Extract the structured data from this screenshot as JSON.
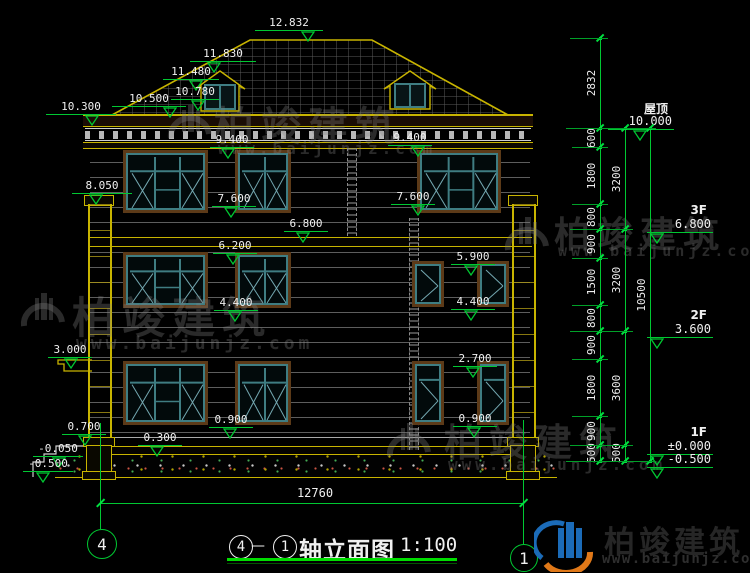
{
  "title_block": {
    "axis_start": "4",
    "separator": "—",
    "axis_end": "1",
    "name": "轴立面图",
    "scale": "1:100"
  },
  "brand": {
    "name": "柏竣建筑",
    "url": "www.baijunjz.com"
  },
  "bottom_dimension": {
    "overall_width": "12760"
  },
  "axis_bubbles": [
    {
      "number": "4",
      "cx": 101,
      "cy": 543,
      "r": 14
    },
    {
      "number": "1",
      "cx": 523,
      "cy": 557,
      "r": 13
    }
  ],
  "colors": {
    "dim_green": "#00c832",
    "bright_green": "#00e040",
    "text_white": "#f0f0f0",
    "outline_yellow": "#c8b400",
    "window_teal": "#3f7d82",
    "glazing_teal": "#74a8b1",
    "frame_brown": "#5c3a18",
    "watermark_gray": "rgba(130,130,130,0.32)",
    "logo_blue": "#1b6bb8",
    "logo_orange": "#e07818",
    "title_underline": "#00dd00"
  },
  "elevation_markers": [
    {
      "v": "12.832",
      "x": 255,
      "y": 31,
      "w": 68,
      "tx": 308
    },
    {
      "v": "11.830",
      "x": 190,
      "y": 62,
      "w": 66,
      "tx": 214
    },
    {
      "v": "11.480",
      "x": 163,
      "y": 80,
      "w": 56,
      "tx": 196
    },
    {
      "v": "10.780",
      "x": 171,
      "y": 100,
      "w": 48,
      "tx": 198
    },
    {
      "v": "10.500",
      "x": 112,
      "y": 107,
      "w": 74,
      "tx": 170
    },
    {
      "v": "10.300",
      "x": 46,
      "y": 115,
      "w": 70,
      "tx": 92
    },
    {
      "v": "9.400",
      "x": 210,
      "y": 148,
      "w": 44,
      "tx": 228
    },
    {
      "v": "9.400",
      "x": 388,
      "y": 146,
      "w": 44,
      "tx": 418
    },
    {
      "v": "8.050",
      "x": 72,
      "y": 194,
      "w": 60,
      "tx": 96
    },
    {
      "v": "7.600",
      "x": 212,
      "y": 207,
      "w": 44,
      "tx": 231
    },
    {
      "v": "7.600",
      "x": 391,
      "y": 205,
      "w": 44,
      "tx": 418
    },
    {
      "v": "6.800",
      "x": 284,
      "y": 232,
      "w": 44,
      "tx": 303
    },
    {
      "v": "6.200",
      "x": 213,
      "y": 254,
      "w": 44,
      "tx": 233
    },
    {
      "v": "5.900",
      "x": 451,
      "y": 265,
      "w": 44,
      "tx": 471
    },
    {
      "v": "4.400",
      "x": 214,
      "y": 311,
      "w": 44,
      "tx": 235
    },
    {
      "v": "4.400",
      "x": 451,
      "y": 310,
      "w": 44,
      "tx": 471
    },
    {
      "v": "3.000",
      "x": 48,
      "y": 358,
      "w": 44,
      "tx": 71
    },
    {
      "v": "2.700",
      "x": 453,
      "y": 367,
      "w": 44,
      "tx": 473
    },
    {
      "v": "0.900",
      "x": 209,
      "y": 428,
      "w": 44,
      "tx": 230
    },
    {
      "v": "0.900",
      "x": 453,
      "y": 427,
      "w": 44,
      "tx": 474
    },
    {
      "v": "0.700",
      "x": 62,
      "y": 435,
      "w": 44,
      "tx": 85
    },
    {
      "v": "0.300",
      "x": 138,
      "y": 446,
      "w": 44,
      "tx": 157
    },
    {
      "v": "-0.050",
      "x": 33,
      "y": 457,
      "w": 50,
      "tx": 59
    },
    {
      "v": "-0.500",
      "x": 23,
      "y": 472,
      "w": 50,
      "tx": 43
    }
  ],
  "floor_levels": [
    {
      "floor": "屋顶",
      "value": "10.000",
      "x": 608,
      "y": 130,
      "w": 66,
      "tx": 640
    },
    {
      "floor": "3F",
      "value": "6.800",
      "x": 647,
      "y": 233,
      "w": 66,
      "tx": 657
    },
    {
      "floor": "2F",
      "value": "3.600",
      "x": 647,
      "y": 338,
      "w": 66,
      "tx": 657
    },
    {
      "floor": "1F",
      "value": "±0.000",
      "x": 647,
      "y": 455,
      "w": 66,
      "tx": 657
    },
    {
      "floor": "",
      "value": "-0.500",
      "x": 647,
      "y": 468,
      "w": 66,
      "tx": 657
    }
  ],
  "dim_chains": [
    {
      "x": 600,
      "boundaries": [
        38,
        128,
        147,
        204,
        229,
        258,
        305,
        331,
        359,
        416,
        445,
        461
      ],
      "labels": [
        "2832",
        "600",
        "1800",
        "800",
        "900",
        "1500",
        "800",
        "900",
        "1800",
        "900",
        "500"
      ]
    },
    {
      "x": 625,
      "boundaries": [
        128,
        229,
        331,
        445,
        461
      ],
      "labels": [
        "3200",
        "3200",
        "3600",
        "500"
      ]
    },
    {
      "x": 650,
      "boundaries": [
        128,
        461
      ],
      "labels": [
        "10500"
      ]
    }
  ],
  "extension_lines": [
    {
      "y": 38,
      "x1": 570,
      "x2": 608
    },
    {
      "y": 128,
      "x1": 566,
      "x2": 656
    },
    {
      "y": 147,
      "x1": 572,
      "x2": 608
    },
    {
      "y": 204,
      "x1": 572,
      "x2": 608
    },
    {
      "y": 229,
      "x1": 570,
      "x2": 633
    },
    {
      "y": 258,
      "x1": 572,
      "x2": 608
    },
    {
      "y": 305,
      "x1": 572,
      "x2": 608
    },
    {
      "y": 331,
      "x1": 570,
      "x2": 633
    },
    {
      "y": 359,
      "x1": 572,
      "x2": 608
    },
    {
      "y": 416,
      "x1": 572,
      "x2": 608
    },
    {
      "y": 445,
      "x1": 570,
      "x2": 633
    },
    {
      "y": 461,
      "x1": 566,
      "x2": 656
    }
  ],
  "windows": [
    {
      "x": 123,
      "y": 150,
      "w": 85,
      "h": 63,
      "type": "w3"
    },
    {
      "x": 235,
      "y": 150,
      "w": 56,
      "h": 63,
      "type": "w2"
    },
    {
      "x": 417,
      "y": 150,
      "w": 84,
      "h": 63,
      "type": "w3"
    },
    {
      "x": 123,
      "y": 252,
      "w": 85,
      "h": 56,
      "type": "w3"
    },
    {
      "x": 235,
      "y": 252,
      "w": 56,
      "h": 56,
      "type": "w2"
    },
    {
      "x": 412,
      "y": 261,
      "w": 32,
      "h": 46,
      "type": "cas"
    },
    {
      "x": 477,
      "y": 261,
      "w": 32,
      "h": 46,
      "type": "cas"
    },
    {
      "x": 123,
      "y": 361,
      "w": 85,
      "h": 64,
      "type": "w3"
    },
    {
      "x": 235,
      "y": 361,
      "w": 56,
      "h": 64,
      "type": "w2"
    },
    {
      "x": 412,
      "y": 361,
      "w": 32,
      "h": 64,
      "type": "nar"
    },
    {
      "x": 477,
      "y": 361,
      "w": 32,
      "h": 64,
      "type": "nar"
    }
  ],
  "watermarks": [
    {
      "x": 163,
      "y": 100,
      "tx": 214,
      "ty": 94,
      "uy": 139,
      "big": 40,
      "url": 16
    },
    {
      "x": 16,
      "y": 288,
      "tx": 72,
      "ty": 284,
      "uy": 333,
      "big": 43,
      "url": 18
    },
    {
      "x": 500,
      "y": 212,
      "tx": 554,
      "ty": 206,
      "uy": 242,
      "big": 36,
      "url": 15
    },
    {
      "x": 382,
      "y": 418,
      "tx": 444,
      "ty": 412,
      "uy": 455,
      "big": 38,
      "url": 16
    }
  ]
}
